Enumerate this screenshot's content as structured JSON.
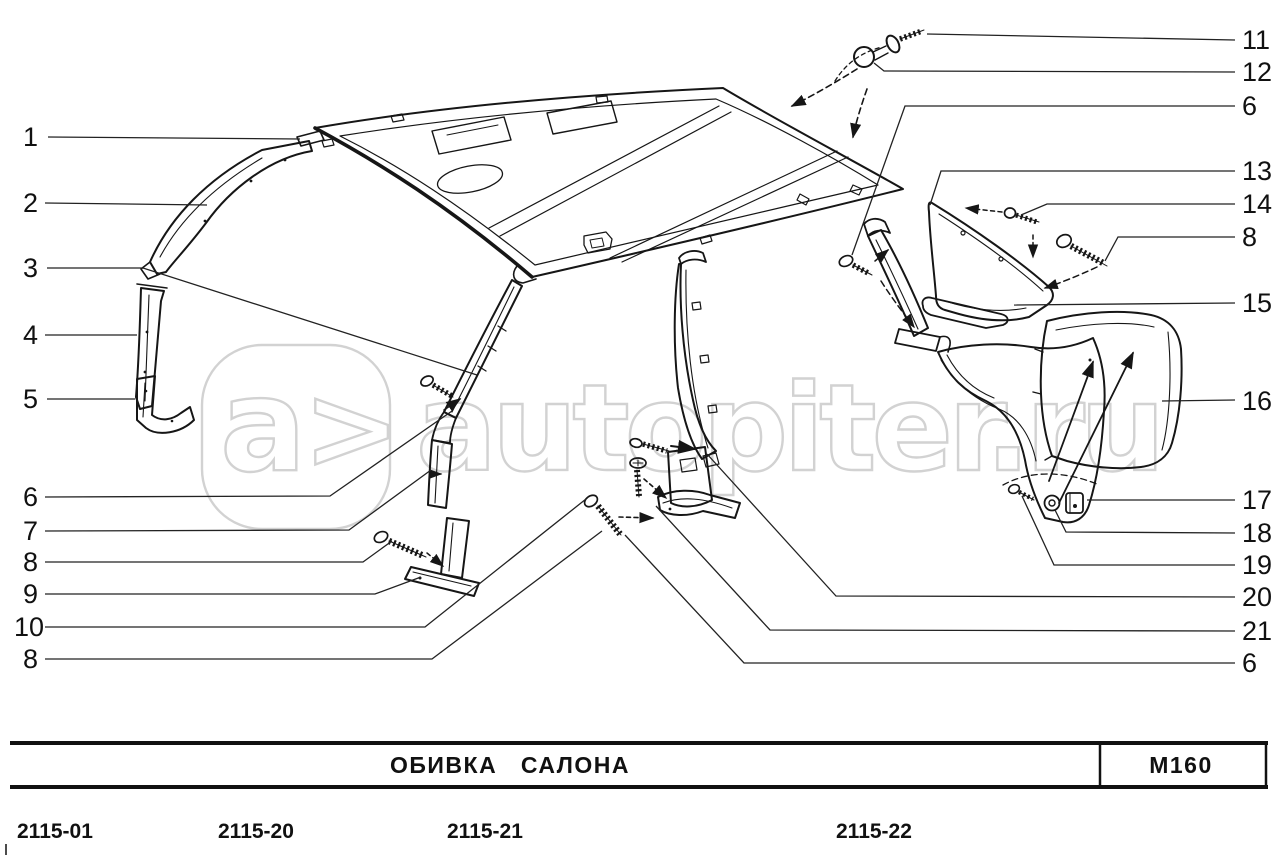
{
  "colors": {
    "ink": "#161616",
    "watermark": "#d2d2d2",
    "background": "#ffffff"
  },
  "watermark": {
    "letter": "a",
    "chevron": ">",
    "brand": "autopiter",
    "suffix": ".ru"
  },
  "callouts": {
    "left": [
      "1",
      "2",
      "3",
      "4",
      "5",
      "6",
      "7",
      "8",
      "9",
      "10",
      "8"
    ],
    "right": [
      "11",
      "12",
      "6",
      "13",
      "14",
      "8",
      "15",
      "16",
      "17",
      "18",
      "19",
      "20",
      "21",
      "6"
    ]
  },
  "title_block": {
    "title": "ОБИВКА   САЛОНА",
    "code": "M160"
  },
  "variant_codes": [
    "2115-01",
    "2115-20",
    "2115-21",
    "2115-22"
  ]
}
